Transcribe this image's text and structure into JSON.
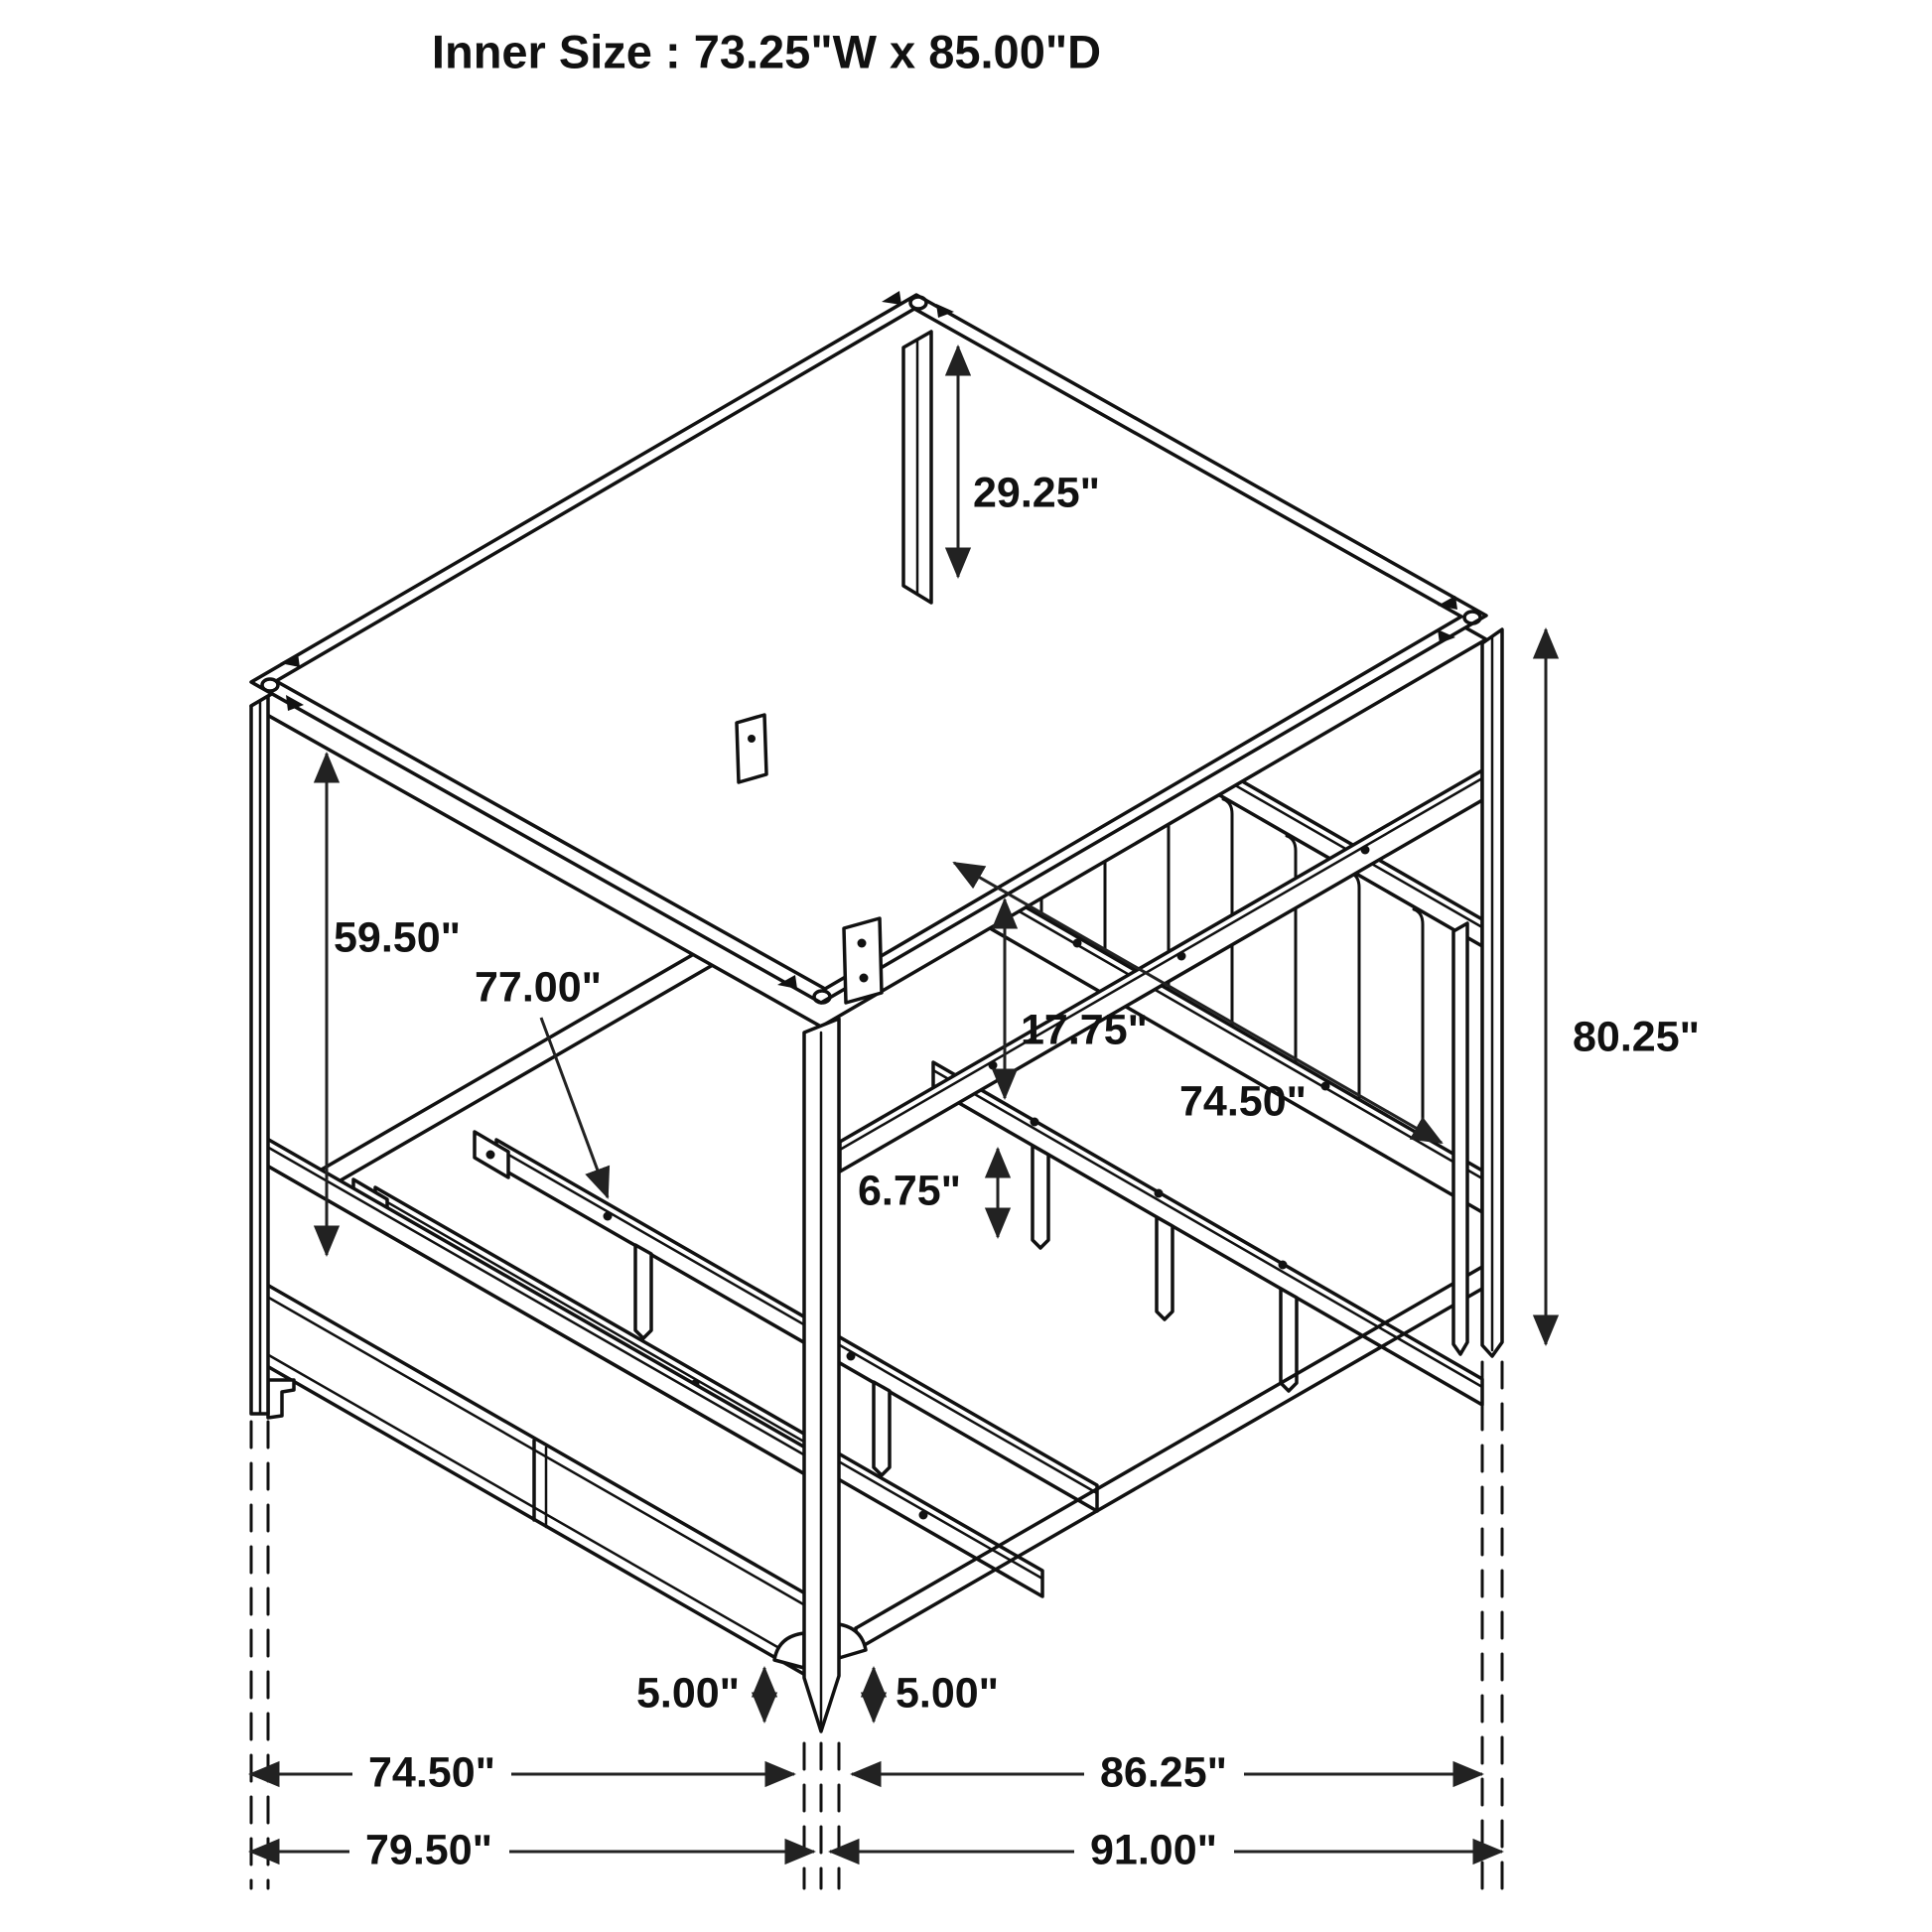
{
  "title": "Inner Size : 73.25\"W x 85.00\"D",
  "colors": {
    "line": "#111111",
    "background": "#ffffff",
    "arrow": "#222222"
  },
  "diagram": {
    "subject": "four-poster canopy storage bed frame, isometric dimension line drawing",
    "inner_width": "73.25\"",
    "inner_depth": "85.00\""
  },
  "dimensions": {
    "headboard_to_canopy": "29.25\"",
    "under_canopy_clearance": "59.50\"",
    "slat_length": "77.00\"",
    "rail_to_slat_height": "17.75\"",
    "inner_side_length": "74.50\"",
    "overall_post_height": "80.25\"",
    "slat_leg_height": "6.75\"",
    "foot_height_left": "5.00\"",
    "foot_height_right": "5.00\"",
    "footboard_side_width": "74.50\"",
    "headboard_side_length": "86.25\"",
    "overall_width": "79.50\"",
    "overall_length": "91.00\""
  }
}
